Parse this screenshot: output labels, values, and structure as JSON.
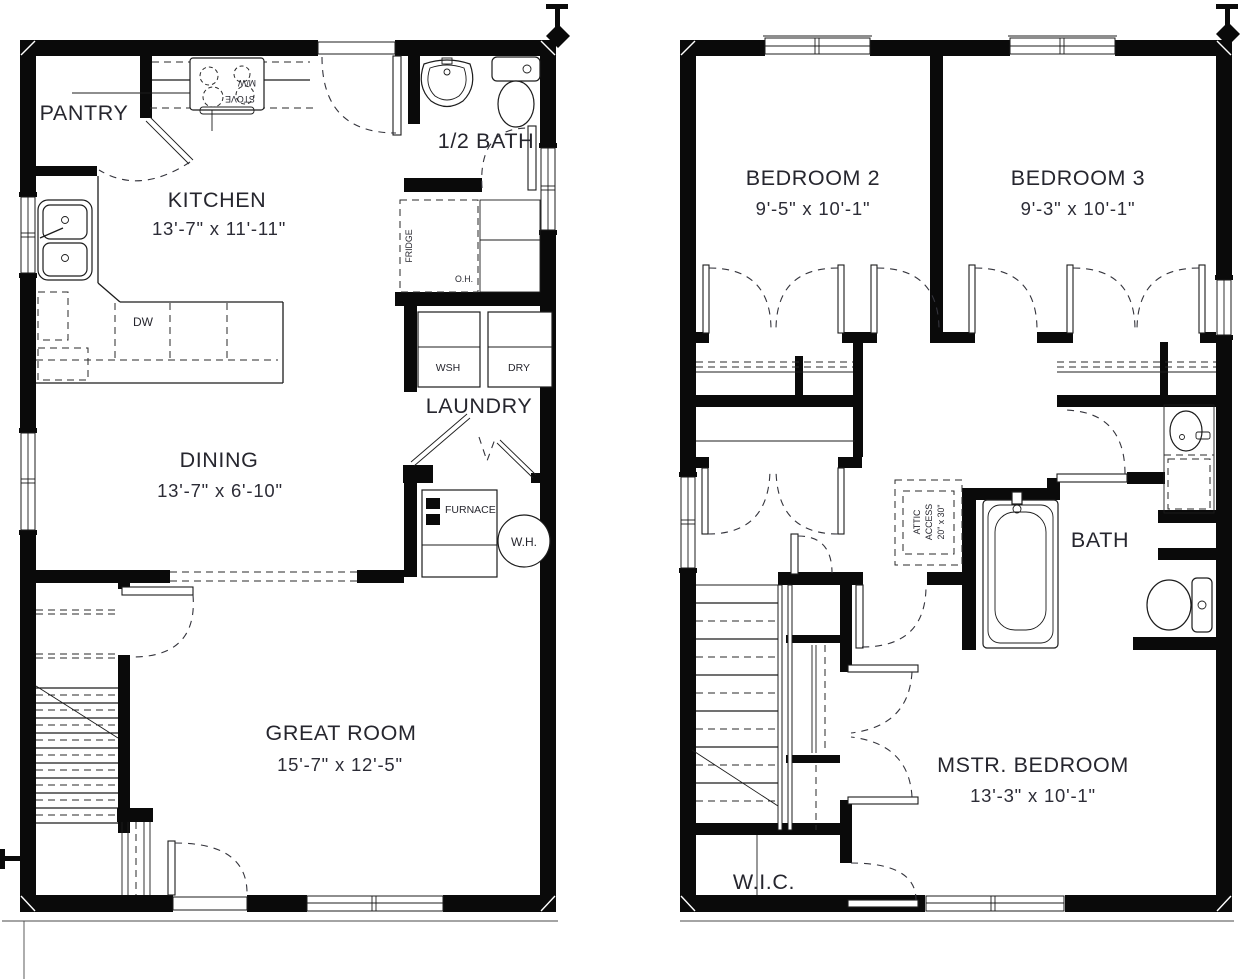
{
  "floor1": {
    "pantry": "PANTRY",
    "kitchen_name": "KITCHEN",
    "kitchen_dims": "13'-7\" x 11'-11\"",
    "half_bath": "1/2 BATH",
    "laundry": "LAUNDRY",
    "dining_name": "DINING",
    "dining_dims": "13'-7\" x 6'-10\"",
    "great_room_name": "GREAT ROOM",
    "great_room_dims": "15'-7\" x 12'-5\"",
    "dw": "DW",
    "wsh": "WSH",
    "dry": "DRY",
    "furnace": "FURNACE",
    "water_heater": "W.H.",
    "fridge": "FRIDGE",
    "overhead": "O.H.",
    "stove": "STOVE",
    "microwave": "M/W"
  },
  "floor2": {
    "bedroom2_name": "BEDROOM 2",
    "bedroom2_dims": "9'-5\" x 10'-1\"",
    "bedroom3_name": "BEDROOM 3",
    "bedroom3_dims": "9'-3\" x 10'-1\"",
    "bath": "BATH",
    "attic_line1": "ATTIC",
    "attic_line2": "ACCESS",
    "attic_line3": "20\" x 30\"",
    "master_name": "MSTR. BEDROOM",
    "master_dims": "13'-3\" x 10'-1\"",
    "wic": "W.I.C."
  }
}
